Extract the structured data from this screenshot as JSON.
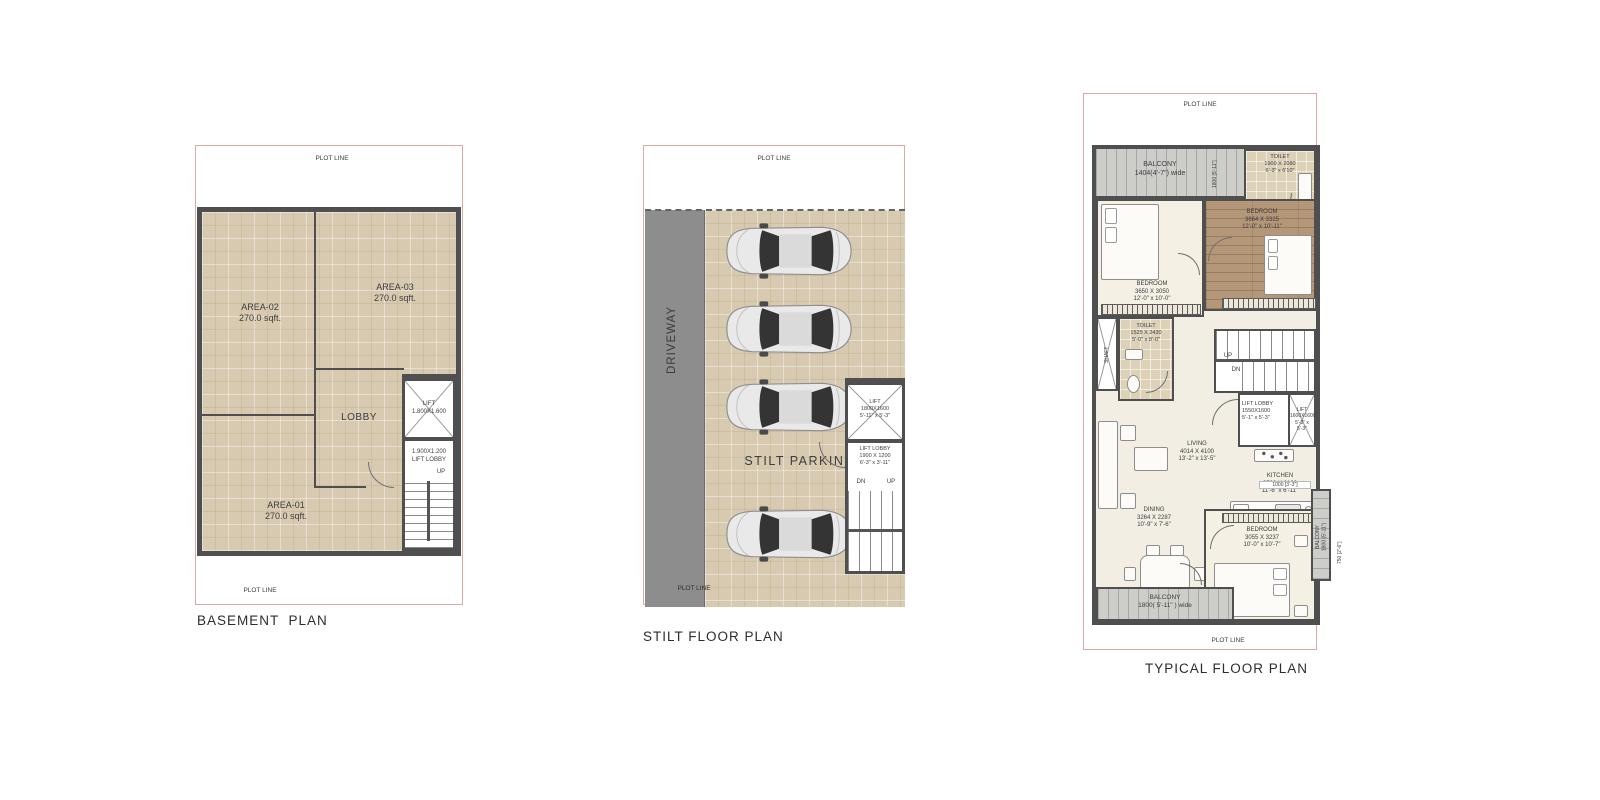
{
  "titles": {
    "basement": "BASEMENT  PLAN",
    "stilt": "STILT FLOOR PLAN",
    "typical": "TYPICAL FLOOR PLAN"
  },
  "common": {
    "plot_line": "PLOT LINE",
    "up": "UP",
    "dn": "DN"
  },
  "basement": {
    "area01": "AREA-01\n270.0 sqft.",
    "area02": "AREA-02\n270.0 sqft.",
    "area03": "AREA-03\n270.0 sqft.",
    "lobby": "LOBBY",
    "lift": "LIFT\n1.800X1.600",
    "lift_lobby": "1.900X1.200\nLIFT LOBBY",
    "up": "UP"
  },
  "stilt": {
    "driveway": "DRIVEWAY",
    "parking": "STILT PARKING",
    "lift": "LIFT\n1800X1600\n5'-11\" x 5'-3\"",
    "lift_lobby": "LIFT LOBBY\n1900 X 1200\n6'-3\" x 3'-11\"",
    "dn": "DN",
    "up": "UP"
  },
  "typical": {
    "balcony_top": "BALCONY\n1404(4'-7\") wide",
    "balcony_top_dim": "1800 [5'-11\"]",
    "toilet_top": "TOILET\n1900 X 2080\n6'-3\" x 6'10\"",
    "bedroom_top": "BEDROOM\n3664 X 3325\n12'-0\" x 10'-11\"",
    "bedroom_left": "BEDROOM\n3650 X 3050\n12'-0\" x 10'-0\"",
    "toilet_left": "TOILET\n1525 X 2430\n5'-0\" x 8'-0\"",
    "shaft": "SHAFT",
    "up": "UP",
    "dn": "DN",
    "lift_lobby": "LIFT LOBBY\n1550X1600\n5'-1\" x 5'-3\"",
    "lift": "LIFT\n1600X1600\n5'-3\" x 5'-3\"",
    "living": "LIVING\n4014 X 4100\n13'-2\" x 13'-5\"",
    "kitchen": "KITCHEN\n3500 X 2100\n11'-6\" x 6'-11\"",
    "dining": "DINING\n3264 X 2287\n10'-9\"  x 7'-6\"",
    "bedroom_bottom": "BEDROOM\n3055 X 3237\n10'-0\" x 10'-7\"",
    "balcony_bottom": "BALCONY\n1800( 5'-11\" ) wide",
    "balcony_right": "BALCONY\n1800 (5'-11\")",
    "dim_1000": "1000 [3'-3\"]",
    "dim_750": "750 [2'-6\"]"
  },
  "colors": {
    "plot_line": "#dcaaa6",
    "wall": "#4f4f4f",
    "floor_tile": "#d8cab0",
    "driveway": "#8d8d8d",
    "wood_floor": "#b49778",
    "balcony_plank": "#cdcdca",
    "marble": "#f2eee4"
  }
}
